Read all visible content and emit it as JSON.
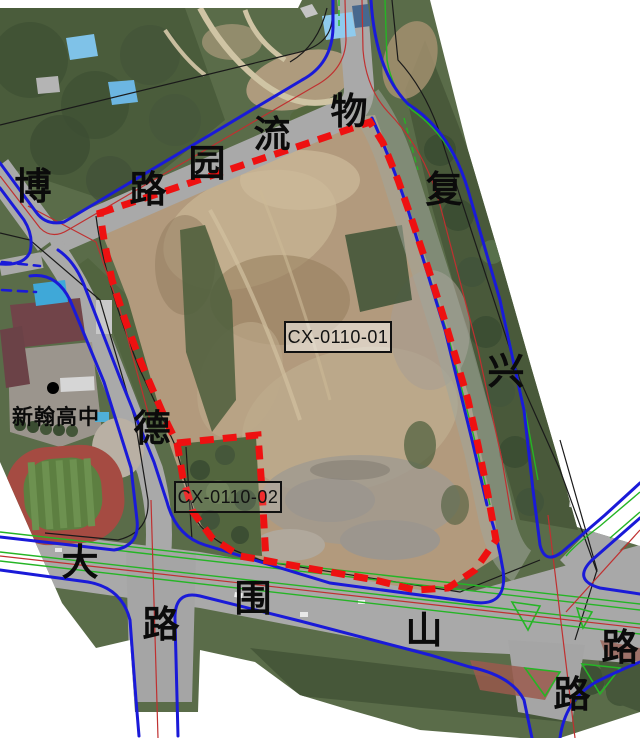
{
  "map": {
    "type": "aerial-planning-map",
    "parcels": {
      "p1": {
        "code": "CX-0110-01"
      },
      "p2": {
        "code": "CX-0110-02"
      }
    },
    "labels": {
      "school": "新翰高中",
      "roads": {
        "bo": "博",
        "lu_top": "路",
        "yuan": "园",
        "liu": "流",
        "wu": "物",
        "fu": "复",
        "xing": "兴",
        "de": "德",
        "da": "大",
        "lu_south_left": "路",
        "wei": "围",
        "shan": "山",
        "lu_east": "路",
        "lu_south_right": "路"
      }
    },
    "colors": {
      "boundary_red": "#ee1111",
      "road_blue": "#1a1ad8",
      "green_line": "#25b525",
      "centerline_red": "#c03030",
      "black_line": "#1a1a1a",
      "label_text": "#0b0b0b"
    }
  }
}
